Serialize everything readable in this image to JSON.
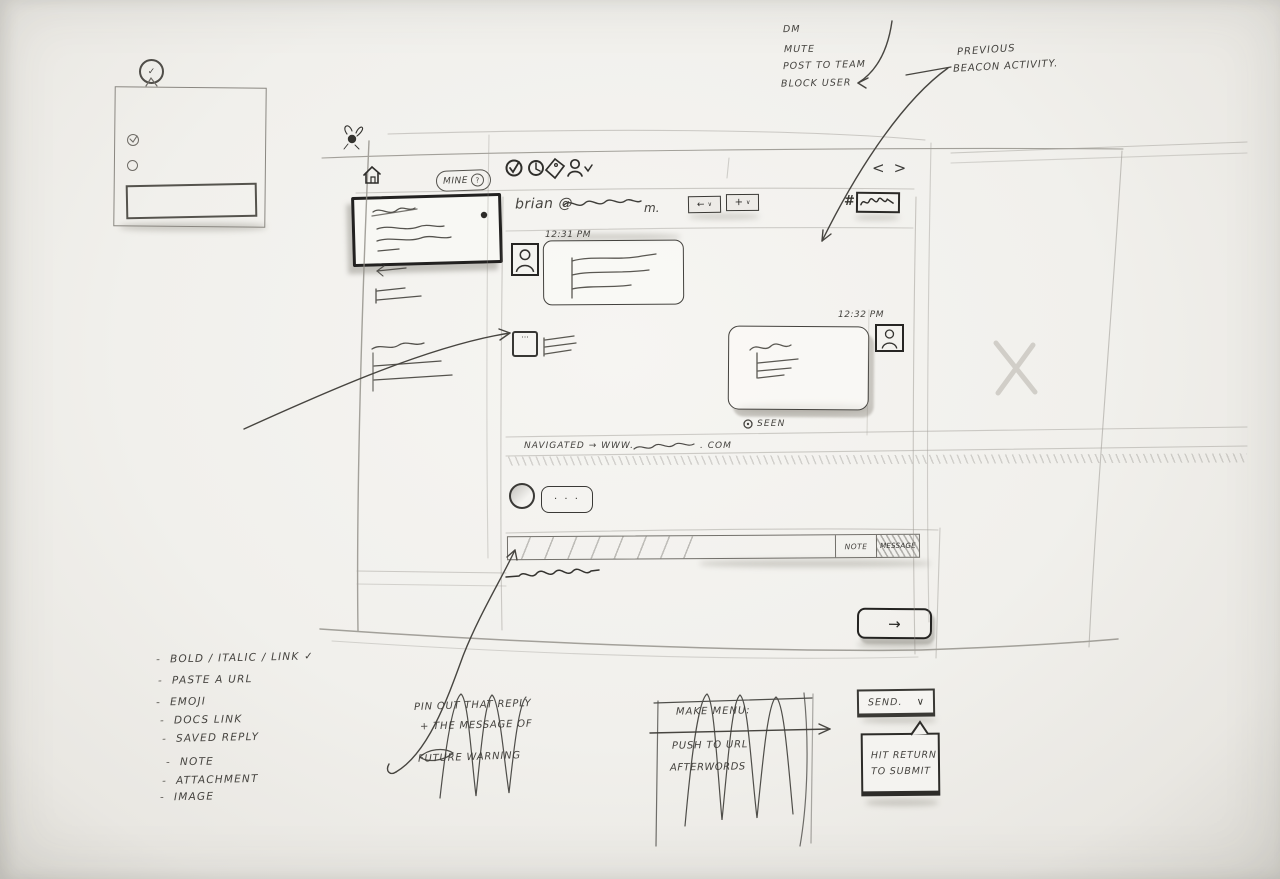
{
  "icons": {
    "check": "✓",
    "reply_arrow": "←",
    "plus": "+",
    "caret": "∨",
    "typing_dots": "···",
    "submit_arrow": "→"
  },
  "notes": {
    "context_menu": [
      "DM",
      "Mute",
      "Post to team",
      "Block user"
    ],
    "previous_activity": [
      "Previous",
      "beacon activity."
    ],
    "reply_note": [
      "Pin out that reply",
      "+ the message of",
      "future warning"
    ],
    "features": [
      "Bold / Italic / Link ✓",
      "Paste a URL",
      "Emoji",
      "Docs link",
      "Saved reply",
      "Note",
      "Attachment",
      "Image"
    ],
    "make_menu": {
      "title": "Make menu:",
      "item1": "Push to URL",
      "item2": "Afterwords"
    },
    "send": {
      "label": "Send.",
      "caret": "∨"
    },
    "tooltip": [
      "Hit return",
      "to submit"
    ]
  },
  "ui": {
    "mine_label": "Mine",
    "mine_badge": "?",
    "nav_back": "<",
    "nav_forward": ">",
    "header_from": "brian @",
    "header_suffix": "m.",
    "hash": "#",
    "time1": "12:31 PM",
    "time2": "12:32 PM",
    "seen": "Seen",
    "event_prefix": "Navigated → www.",
    "event_suffix": ". com",
    "typing": "· · ·",
    "tab_note": "Note",
    "tab_message": "Message"
  }
}
